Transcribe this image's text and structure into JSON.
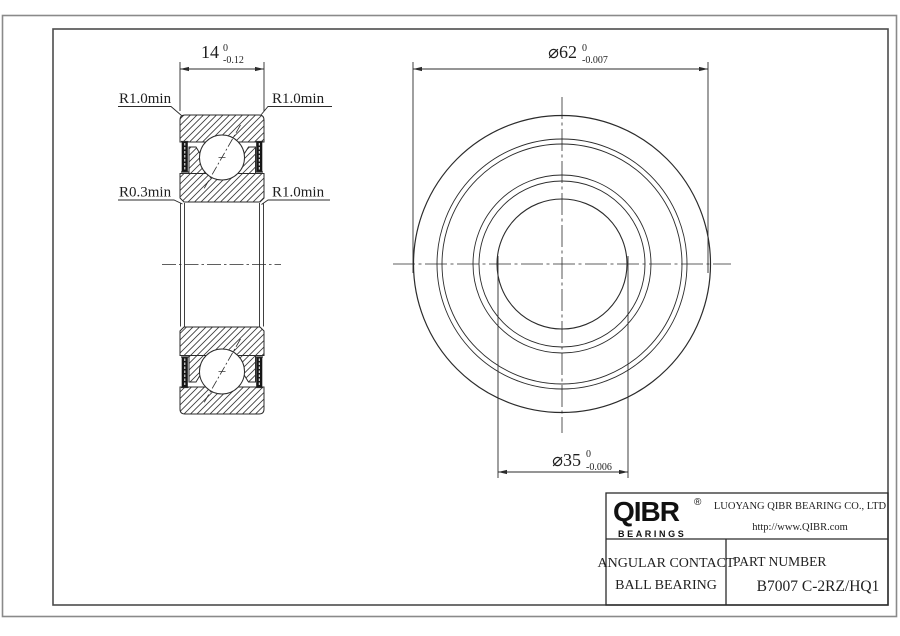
{
  "drawing": {
    "left_view": {
      "dim_width": {
        "text": "14",
        "tol_upper": "0",
        "tol_lower": "-0.12"
      },
      "radius_labels": {
        "top_left": "R1.0min",
        "top_right": "R1.0min",
        "mid_left": "R0.3min",
        "mid_right": "R1.0min"
      }
    },
    "front_view": {
      "dim_outer_diameter": {
        "text": "⌀62",
        "tol_upper": "0",
        "tol_lower": "-0.007"
      },
      "dim_bore_diameter": {
        "text": "⌀35",
        "tol_upper": "0",
        "tol_lower": "-0.006"
      }
    }
  },
  "title_block": {
    "logo": {
      "text": "QIBR",
      "registered": "®",
      "subtext": "BEARINGS"
    },
    "company": {
      "line1": "LUOYANG QIBR BEARING CO., LTD",
      "line2": "http://www.QIBR.com"
    },
    "product": {
      "line1": "ANGULAR CONTACT",
      "line2": "BALL BEARING"
    },
    "part": {
      "label": "PART NUMBER",
      "number": "B7007 C-2RZ/HQ1"
    }
  },
  "colors": {
    "line": "#2b2b2b",
    "frame_outer": "#8a8a8a",
    "frame_inner": "#4d4d4d",
    "background": "#ffffff"
  }
}
